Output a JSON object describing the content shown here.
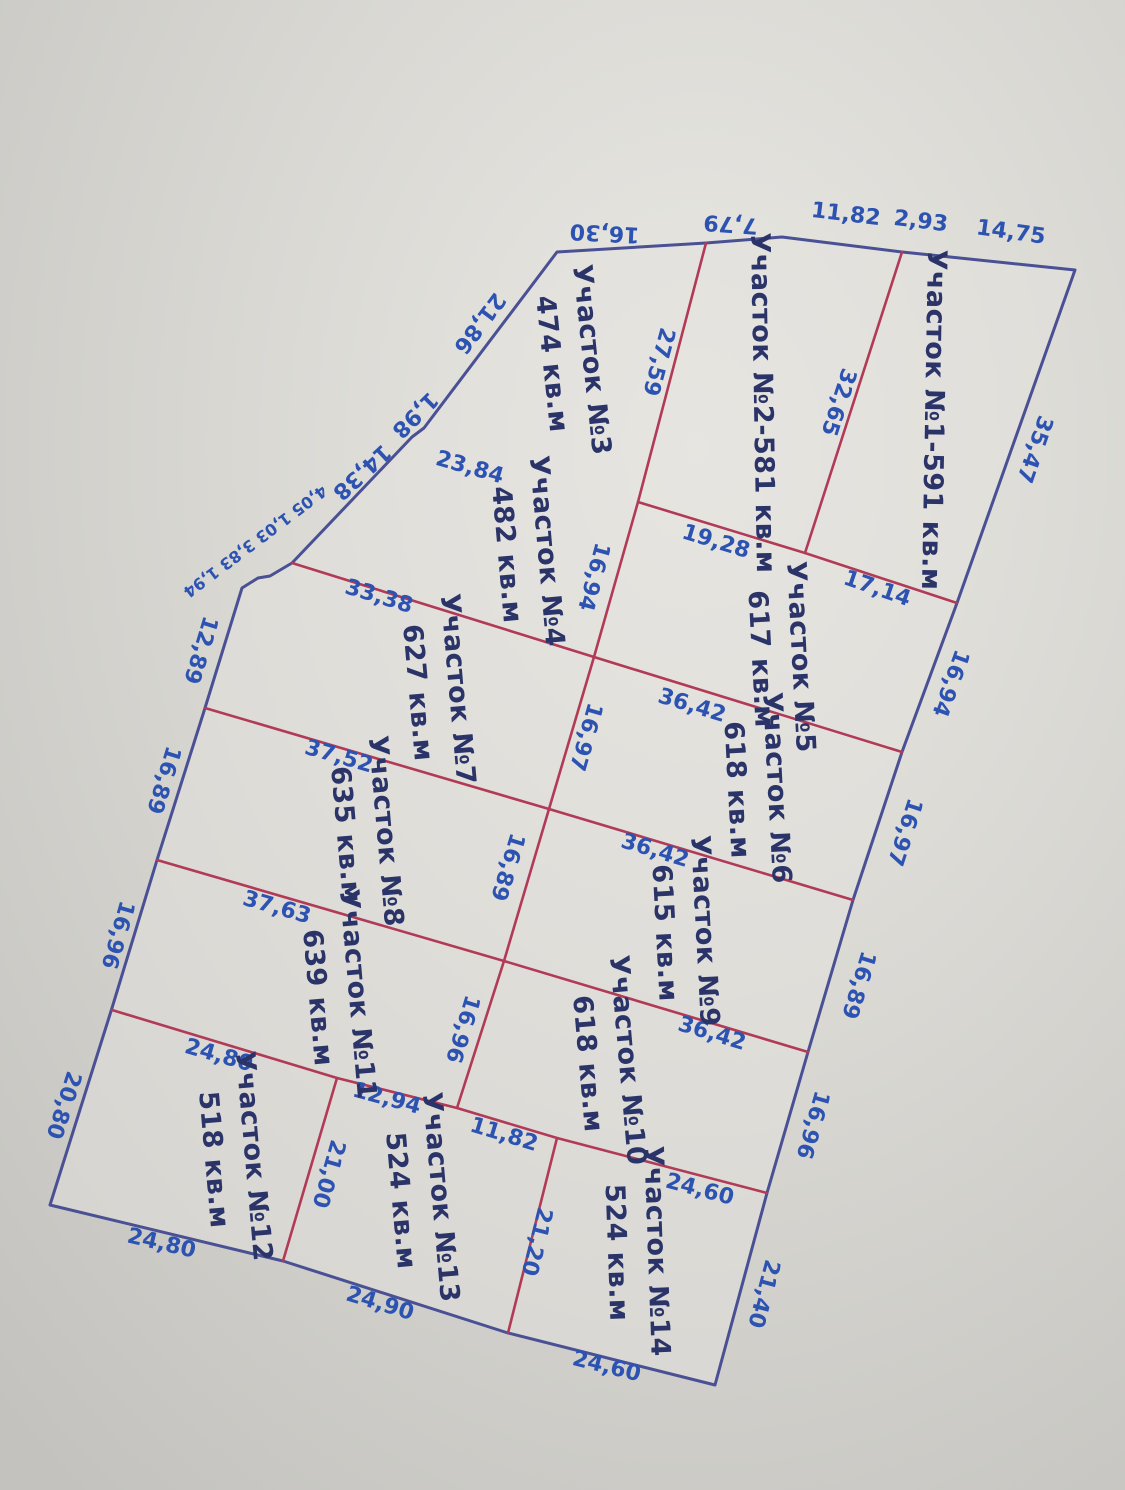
{
  "colors": {
    "paper_light": "#e9e8e3",
    "paper_mid": "#d9d8d3",
    "paper_dark": "#c3c2be",
    "boundary_blue": "#4a5094",
    "divider_red": "#b13a56",
    "parcel_text": "#2b3468",
    "measure_text": "#2d53b2"
  },
  "plan": {
    "boundary_points": [
      [
        557,
        252
      ],
      [
        706,
        243
      ],
      [
        782,
        237
      ],
      [
        902,
        252
      ],
      [
        931,
        255
      ],
      [
        1075,
        270
      ],
      [
        957,
        603
      ],
      [
        902,
        752
      ],
      [
        853,
        900
      ],
      [
        808,
        1052
      ],
      [
        767,
        1193
      ],
      [
        715,
        1385
      ],
      [
        508,
        1333
      ],
      [
        283,
        1261
      ],
      [
        50,
        1205
      ],
      [
        112,
        1008
      ],
      [
        157,
        860
      ],
      [
        205,
        708
      ],
      [
        242,
        588
      ],
      [
        258,
        578
      ],
      [
        270,
        576
      ],
      [
        292,
        563
      ],
      [
        412,
        437
      ],
      [
        424,
        428
      ]
    ],
    "red_lines": [
      {
        "name": "longitudinal-divider",
        "points": [
          [
            706,
            243
          ],
          [
            638,
            502
          ],
          [
            594,
            657
          ],
          [
            549,
            809
          ],
          [
            504,
            961
          ],
          [
            457,
            1108
          ]
        ]
      },
      {
        "name": "divider-parcel1-2",
        "points": [
          [
            902,
            252
          ],
          [
            805,
            553
          ]
        ]
      },
      {
        "name": "row-divider-1-2",
        "points": [
          [
            638,
            502
          ],
          [
            805,
            553
          ],
          [
            957,
            603
          ]
        ]
      },
      {
        "name": "row-divider-2-3",
        "points": [
          [
            292,
            563
          ],
          [
            594,
            657
          ],
          [
            902,
            752
          ]
        ]
      },
      {
        "name": "row-divider-3-4",
        "points": [
          [
            205,
            708
          ],
          [
            549,
            809
          ],
          [
            853,
            900
          ]
        ]
      },
      {
        "name": "row-divider-4-5",
        "points": [
          [
            157,
            860
          ],
          [
            504,
            961
          ],
          [
            808,
            1052
          ]
        ]
      },
      {
        "name": "row-divider-5-6",
        "points": [
          [
            112,
            1010
          ],
          [
            337,
            1078
          ],
          [
            457,
            1108
          ],
          [
            557,
            1138
          ],
          [
            767,
            1193
          ]
        ]
      },
      {
        "name": "divider-parcel12-13",
        "points": [
          [
            337,
            1078
          ],
          [
            283,
            1261
          ]
        ]
      },
      {
        "name": "divider-parcel13-14",
        "points": [
          [
            557,
            1138
          ],
          [
            508,
            1333
          ]
        ]
      }
    ],
    "parcels": [
      {
        "id": "1",
        "x": 934,
        "y": 420,
        "rot": 91,
        "lines": [
          "Участок №1-591 кв.м"
        ]
      },
      {
        "id": "2",
        "x": 763,
        "y": 403,
        "rot": 89,
        "lines": [
          "Участок №2-581 кв.м"
        ]
      },
      {
        "id": "3",
        "x": 571,
        "y": 362,
        "rot": 84,
        "lines": [
          "Участок №3",
          "474 кв.м"
        ]
      },
      {
        "id": "4",
        "x": 526,
        "y": 553,
        "rot": 85,
        "lines": [
          "Участок №4",
          "482 кв.м"
        ]
      },
      {
        "id": "5",
        "x": 780,
        "y": 658,
        "rot": 87,
        "lines": [
          "Участок №5",
          "617 кв.м"
        ]
      },
      {
        "id": "6",
        "x": 756,
        "y": 789,
        "rot": 87,
        "lines": [
          "Участок №6",
          "618 кв.м"
        ]
      },
      {
        "id": "7",
        "x": 437,
        "y": 691,
        "rot": 85,
        "lines": [
          "Участок №7",
          "627 кв.м"
        ]
      },
      {
        "id": "8",
        "x": 365,
        "y": 833,
        "rot": 85,
        "lines": [
          "Участок №8",
          "635 кв.м"
        ]
      },
      {
        "id": "9",
        "x": 684,
        "y": 932,
        "rot": 87,
        "lines": [
          "Участок №9",
          "615 кв.м"
        ]
      },
      {
        "id": "10",
        "x": 607,
        "y": 1062,
        "rot": 85,
        "lines": [
          "Участок №10",
          "618 кв.м"
        ]
      },
      {
        "id": "11",
        "x": 337,
        "y": 996,
        "rot": 85,
        "lines": [
          "Участок №11",
          "639 кв.м"
        ]
      },
      {
        "id": "12",
        "x": 233,
        "y": 1158,
        "rot": 85,
        "lines": [
          "Участок №12",
          "518 кв.м"
        ]
      },
      {
        "id": "13",
        "x": 420,
        "y": 1199,
        "rot": 85,
        "lines": [
          "Участок №13",
          "524 кв.м"
        ]
      },
      {
        "id": "14",
        "x": 636,
        "y": 1252,
        "rot": 88,
        "lines": [
          "Участок №14",
          "524 кв.м"
        ]
      }
    ],
    "measurements": [
      {
        "text": "16,30",
        "x": 605,
        "y": 226,
        "rot": 183
      },
      {
        "text": "7,79",
        "x": 731,
        "y": 217,
        "rot": 184
      },
      {
        "text": "11,82",
        "x": 845,
        "y": 221,
        "rot": 7
      },
      {
        "text": "2,93",
        "x": 920,
        "y": 228,
        "rot": 7
      },
      {
        "text": "14,75",
        "x": 1010,
        "y": 239,
        "rot": 8
      },
      {
        "text": "35,47",
        "x": 1028,
        "y": 447,
        "rot": 109
      },
      {
        "text": "16,94",
        "x": 944,
        "y": 681,
        "rot": 110
      },
      {
        "text": "16,97",
        "x": 898,
        "y": 830,
        "rot": 108
      },
      {
        "text": "16,89",
        "x": 852,
        "y": 983,
        "rot": 107
      },
      {
        "text": "16,96",
        "x": 806,
        "y": 1123,
        "rot": 106
      },
      {
        "text": "21,40",
        "x": 757,
        "y": 1292,
        "rot": 105
      },
      {
        "text": "24,60",
        "x": 605,
        "y": 1373,
        "rot": 14
      },
      {
        "text": "24,90",
        "x": 378,
        "y": 1310,
        "rot": 17
      },
      {
        "text": "24,80",
        "x": 160,
        "y": 1250,
        "rot": 13
      },
      {
        "text": "20,80",
        "x": 57,
        "y": 1103,
        "rot": 108
      },
      {
        "text": "16,96",
        "x": 111,
        "y": 933,
        "rot": 106
      },
      {
        "text": "16,89",
        "x": 157,
        "y": 778,
        "rot": 107
      },
      {
        "text": "12,89",
        "x": 194,
        "y": 648,
        "rot": 107
      },
      {
        "text": "4,05 1,03 3,83 1,94",
        "x": 252,
        "y": 537,
        "rot": 143,
        "size": 16
      },
      {
        "text": "14,38",
        "x": 357,
        "y": 467,
        "rot": 137
      },
      {
        "text": "1,98",
        "x": 410,
        "y": 410,
        "rot": 135
      },
      {
        "text": "21,86",
        "x": 474,
        "y": 319,
        "rot": 127
      },
      {
        "text": "27,59",
        "x": 652,
        "y": 360,
        "rot": 105
      },
      {
        "text": "32,65",
        "x": 832,
        "y": 400,
        "rot": 108
      },
      {
        "text": "16,94",
        "x": 587,
        "y": 575,
        "rot": 105
      },
      {
        "text": "16,97",
        "x": 579,
        "y": 735,
        "rot": 106
      },
      {
        "text": "16,89",
        "x": 501,
        "y": 865,
        "rot": 107
      },
      {
        "text": "16,96",
        "x": 456,
        "y": 1027,
        "rot": 107
      },
      {
        "text": "19,28",
        "x": 714,
        "y": 548,
        "rot": 17
      },
      {
        "text": "17,14",
        "x": 875,
        "y": 595,
        "rot": 19
      },
      {
        "text": "36,42",
        "x": 690,
        "y": 712,
        "rot": 17
      },
      {
        "text": "36,42",
        "x": 653,
        "y": 857,
        "rot": 17
      },
      {
        "text": "36,42",
        "x": 710,
        "y": 1040,
        "rot": 17
      },
      {
        "text": "23,84",
        "x": 468,
        "y": 474,
        "rot": 16
      },
      {
        "text": "33,38",
        "x": 377,
        "y": 603,
        "rot": 17
      },
      {
        "text": "37,52",
        "x": 337,
        "y": 763,
        "rot": 16
      },
      {
        "text": "37,63",
        "x": 275,
        "y": 914,
        "rot": 16
      },
      {
        "text": "24,80",
        "x": 217,
        "y": 1062,
        "rot": 16
      },
      {
        "text": "12,94",
        "x": 385,
        "y": 1105,
        "rot": 15
      },
      {
        "text": "11,82",
        "x": 502,
        "y": 1141,
        "rot": 17
      },
      {
        "text": "24,60",
        "x": 698,
        "y": 1196,
        "rot": 15
      },
      {
        "text": "21,00",
        "x": 322,
        "y": 1172,
        "rot": 106
      },
      {
        "text": "21,20",
        "x": 530,
        "y": 1240,
        "rot": 104
      }
    ]
  }
}
